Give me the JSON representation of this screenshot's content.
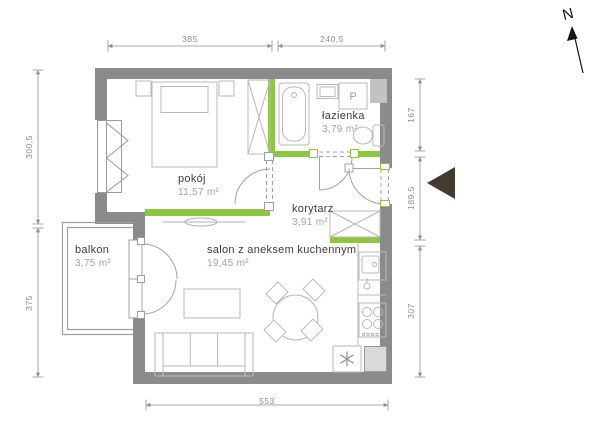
{
  "plan": {
    "compass_label": "N",
    "rooms": [
      {
        "name": "pokój",
        "area": "11,57 m²"
      },
      {
        "name": "łazienka",
        "area": "3,79 m²"
      },
      {
        "name": "korytarz",
        "area": "3,91 m²"
      },
      {
        "name": "salon z aneksem kuchennym",
        "area": "19,45 m²"
      },
      {
        "name": "balkon",
        "area": "3,75 m²"
      }
    ],
    "appliance_labels": {
      "washing_machine": "P"
    },
    "dimensions_cm": {
      "top": [
        "385",
        "240,5"
      ],
      "left": [
        "300,5",
        "375"
      ],
      "right": [
        "167",
        "189,5",
        "307"
      ],
      "bottom": [
        "553"
      ]
    },
    "colors": {
      "wall": "#8b8b8b",
      "accent_green": "#8dc63f",
      "entrance_marker": "#453a2f",
      "shaft_fill": "#c2c2c2",
      "room_name_text": "#3d3d3d",
      "area_text": "#a5a5a5",
      "dimension": "#8f8f8f",
      "furniture_line": "#b8b8b8"
    }
  }
}
